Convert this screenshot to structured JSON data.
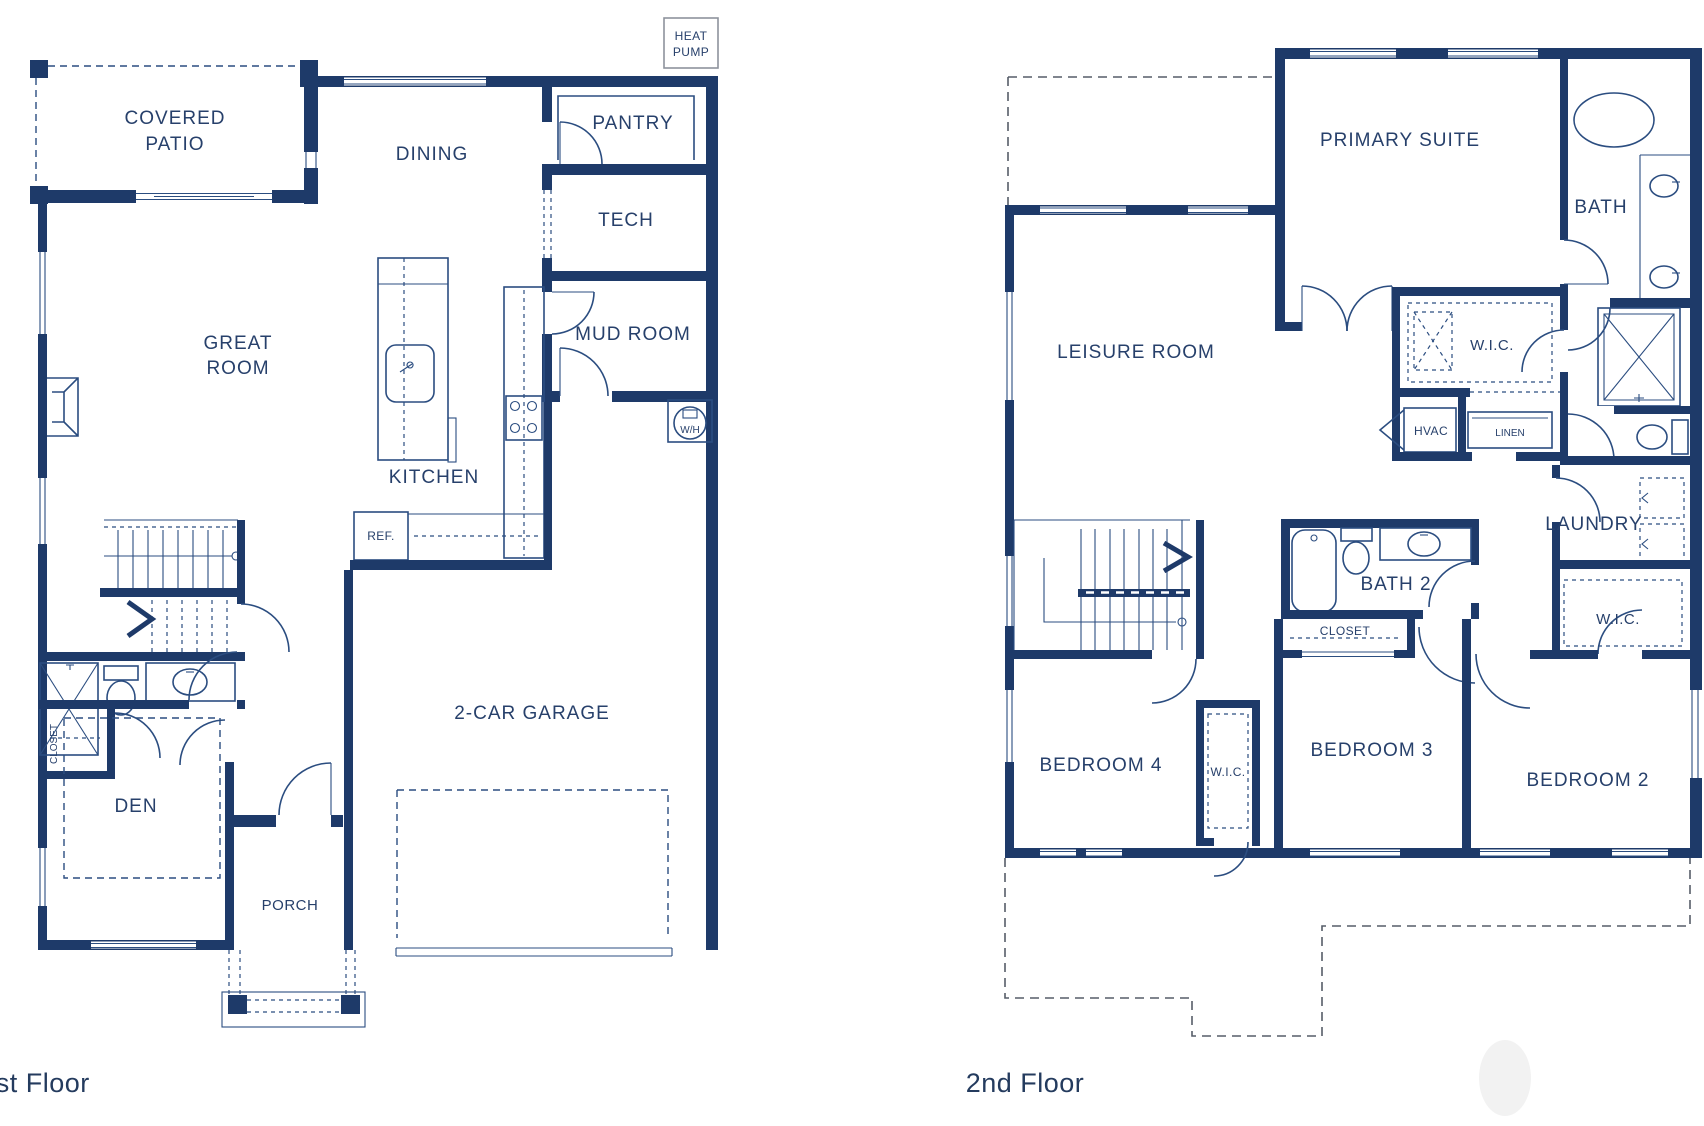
{
  "title": "Two-story house floor plan",
  "palette": {
    "wall_navy": "#1e3a69",
    "line_navy": "#2b4d80",
    "text_navy": "#27406b",
    "roof_dash_gray": "#565d68",
    "equipment_box_gray": "#8d939c"
  },
  "floor1": {
    "label": "1st Floor",
    "rooms": {
      "covered_patio": [
        "COVERED",
        "PATIO"
      ],
      "dining": "DINING",
      "pantry": "PANTRY",
      "tech": "TECH",
      "mud_room": "MUD ROOM",
      "great_room": [
        "GREAT",
        "ROOM"
      ],
      "kitchen": "KITCHEN",
      "garage": "2-CAR GARAGE",
      "den": "DEN",
      "porch": "PORCH",
      "closet": "CLOSET"
    },
    "equipment": {
      "heat_pump": [
        "HEAT",
        "PUMP"
      ],
      "refrigerator": "REF.",
      "water_heater": "W/H"
    }
  },
  "floor2": {
    "label": "2nd Floor",
    "rooms": {
      "primary_suite": "PRIMARY SUITE",
      "bath": "BATH",
      "leisure_room": "LEISURE ROOM",
      "wic_primary": "W.I.C.",
      "hvac": "HVAC",
      "linen": "LINEN",
      "laundry": "LAUNDRY",
      "bath2": "BATH 2",
      "closet_bedroom3": "CLOSET",
      "wic_bedroom2": "W.I.C.",
      "bedroom4": "BEDROOM 4",
      "wic_bedroom4": "W.I.C.",
      "bedroom3": "BEDROOM 3",
      "bedroom2": "BEDROOM 2"
    }
  }
}
